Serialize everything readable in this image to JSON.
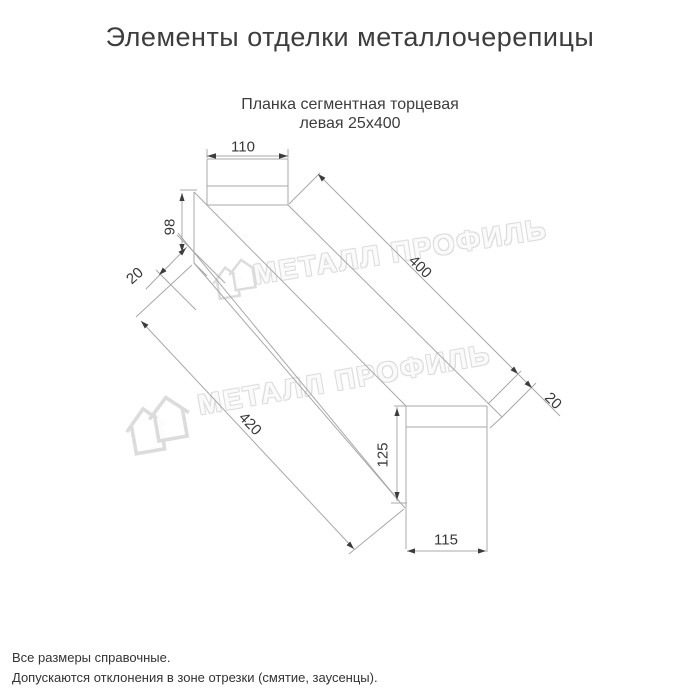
{
  "page": {
    "title": "Элементы отделки металлочерепицы"
  },
  "product": {
    "subtitle_line1": "Планка сегментная торцевая",
    "subtitle_line2": "левая 25х400"
  },
  "drawing": {
    "dims": {
      "top_width": "110",
      "left_height": "98",
      "left_hem": "20",
      "length": "400",
      "right_hem": "20",
      "bottom_length": "420",
      "right_height": "125",
      "bottom_width": "115"
    }
  },
  "watermark": {
    "text": "МЕТАЛЛ ПРОФИЛЬ"
  },
  "footnotes": {
    "line1": "Все размеры справочные.",
    "line2": "Допускаются отклонения в зоне отрезки (смятие, заусенцы)."
  },
  "colors": {
    "line": "#a8a8a8",
    "arrow": "#3c3c3c",
    "text": "#3d3d3d",
    "watermark_outline": "#dcdcdc",
    "background": "#ffffff"
  }
}
